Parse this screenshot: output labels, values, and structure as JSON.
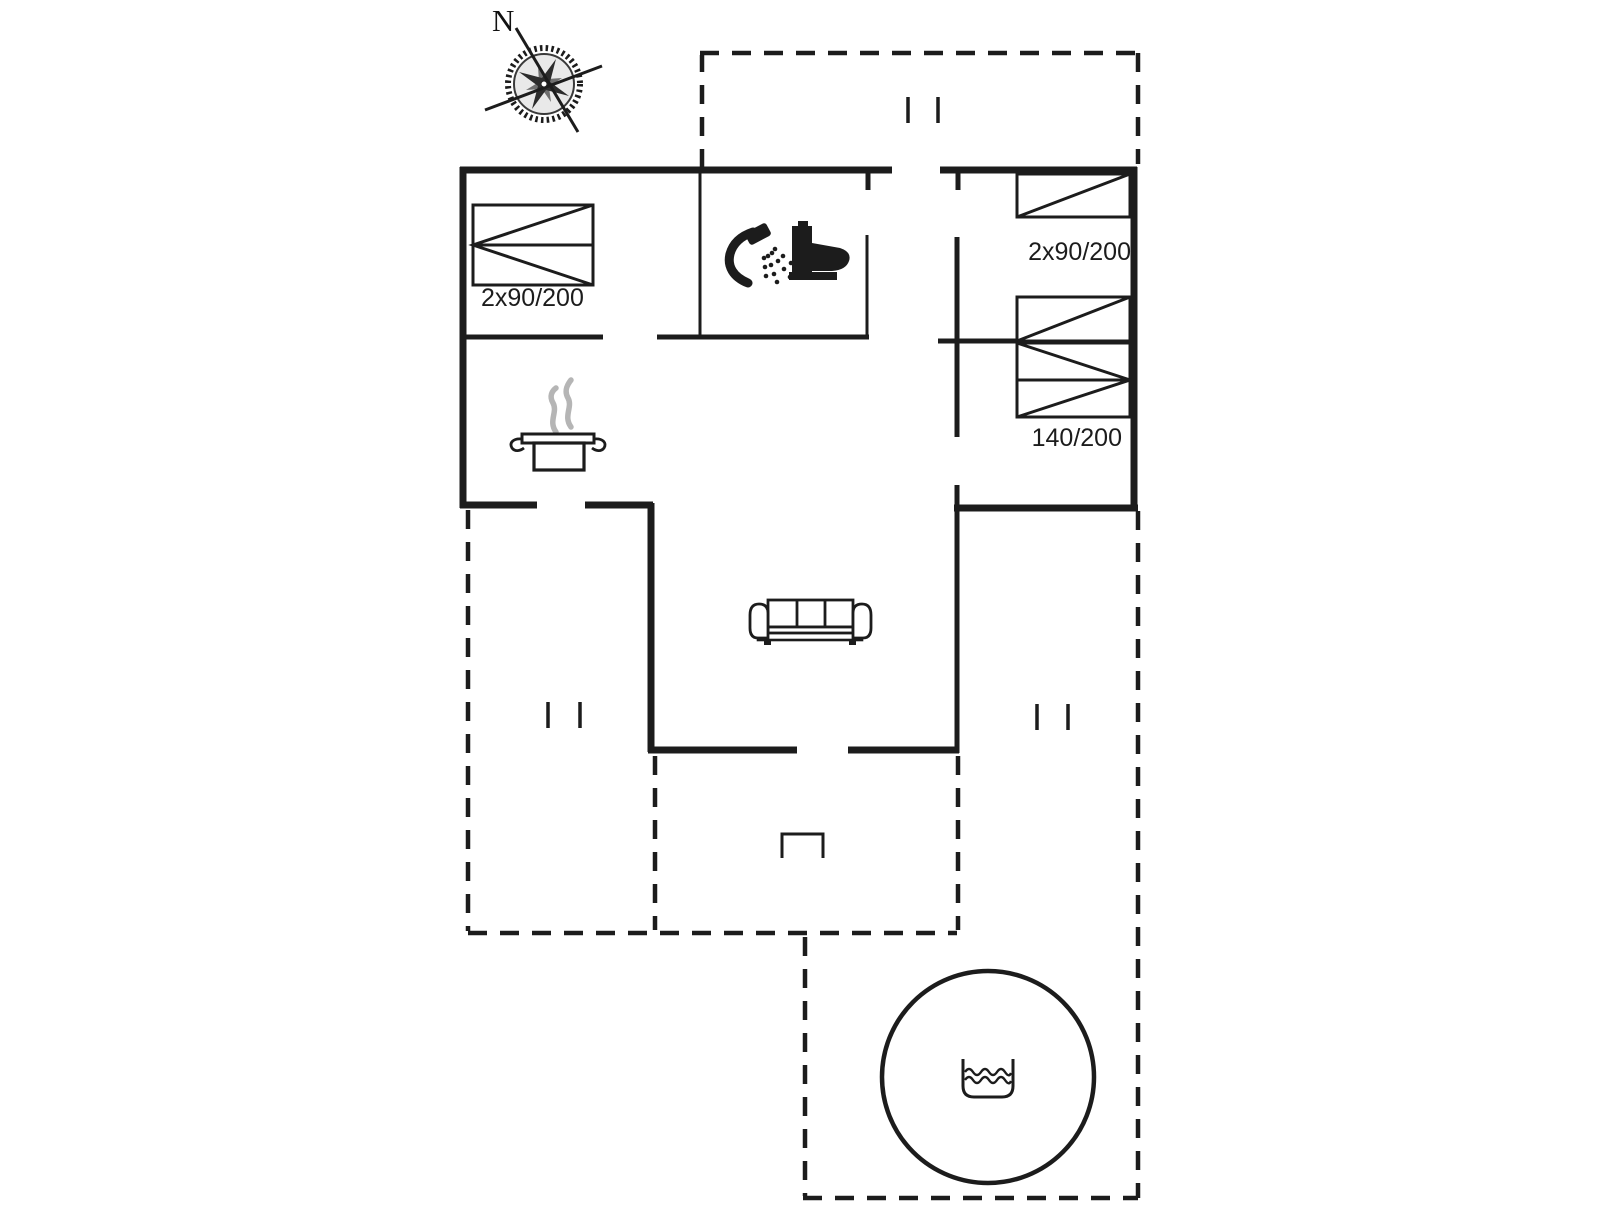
{
  "page": {
    "type": "holiday-home floor plan drawing",
    "background": "#ffffff",
    "ink_color": "#1c1c1c",
    "steam_color": "#b5b5b5"
  },
  "compass": {
    "label": "N",
    "icon": "compass-rose-icon"
  },
  "rooms": {
    "bedroom_left": {
      "bed_label": "2x90/200"
    },
    "bedroom_right_top": {
      "bed_label": "2x90/200"
    },
    "bedroom_right_bottom": {
      "bed_label": "140/200"
    }
  },
  "icons": {
    "compass": "compass-rose-icon",
    "bathroom": [
      "shower-icon",
      "toilet-icon"
    ],
    "kitchen": "cooking-pot-icon",
    "living_room": "sofa-icon",
    "outdoor": "hot-tub-icon",
    "water": "water-waves-icon"
  }
}
